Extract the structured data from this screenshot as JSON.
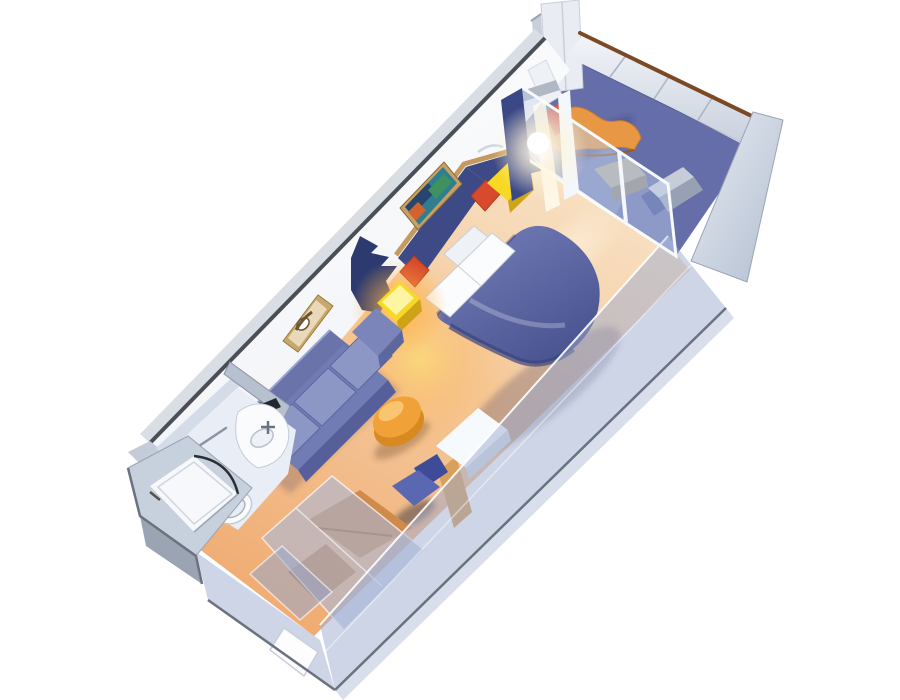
{
  "scene": {
    "type": "3d-cutaway-render",
    "subject": "balcony stateroom floor plan rendering",
    "background": "#ffffff"
  },
  "rooms": [
    {
      "name": "bedroom-sitting-area",
      "floor_color": "#f0ac72"
    },
    {
      "name": "bathroom",
      "floor_color": "#e9eef6"
    },
    {
      "name": "wardrobe-entry-corridor",
      "floor_color": "#f0ac72"
    },
    {
      "name": "private-balcony",
      "floor_color": "#656ea9"
    }
  ],
  "objects": [
    "queen-bed",
    "white-pillows",
    "red-accent-cushion-left",
    "red-accent-cushion-right",
    "nightstand-left-lit",
    "nightstand-right",
    "headboard",
    "privacy-curtain",
    "door-curtain",
    "sofa",
    "coffee-table",
    "vanity-desk",
    "desk-chair",
    "seascape-art",
    "sketch-art",
    "bathroom-vanity",
    "toilet",
    "shower-stall",
    "towel-bar",
    "wardrobe-closet",
    "entry-door",
    "balcony-lounge-chair",
    "balcony-side-table",
    "balcony-chair",
    "balcony-railing",
    "balcony-divider-panel",
    "glass-balcony-door",
    "neighbor-cabin-wall",
    "sun-flare"
  ],
  "palette": {
    "bg": "#ffffff",
    "wall_face": "#fdfdfe",
    "wall_edge_dark": "#4a4f57",
    "wall_outer_strip": "#d9dde4",
    "panel_light": "#e9edf3",
    "panel_mid": "#c8cfdb",
    "rail_brown": "#7a4a26",
    "sail_echo": "#aab4c6",
    "balcony_floor": "#656ea9",
    "lounge_orange": "#e89744",
    "lounge_cushion": "#de5034",
    "balcony_table_top": "#b3ab9c",
    "balcony_table_side": "#8d8679",
    "balcony_chair": "#3d4a90",
    "ac_top": "#c6cdd9",
    "ac_side": "#98a1b4",
    "bed_skirt": "#39437e",
    "pillow": "#fbfcfe",
    "pillow_back": "#eef1f6",
    "cushion_red": "#d84a2c",
    "nightstand_top": "#f7d925",
    "nightstand_side": "#cfa318",
    "nightstand_core": "#fff9b8",
    "headboard_navy": "#3d4a85",
    "headboard_trim": "#c49a5e",
    "curtain_navy": "#2c3a70",
    "door_curtain": "#3a4886",
    "art1_frame": "#c9a063",
    "art1_teal": "#2f7f90",
    "art1_navy": "#27456e",
    "art1_green": "#3f9160",
    "art1_orange": "#d2622e",
    "art2_frame": "#c8a86a",
    "art2_inner": "#ead9b8",
    "sofa_back": "#6a73aa",
    "sofa_seat": "#717cb4",
    "sofa_cushion": "#8d97c6",
    "sofa_skirt": "#565f9a",
    "table_side": "#d8891f",
    "table_top": "#f0a238",
    "desk_top": "#f7fafc",
    "desk_side": "#d4dae4",
    "chair_seat": "#5a68b2",
    "chair_back": "#3e4c98",
    "bath_floor": "#e9eef6",
    "bath_wall_shade": "#d4dce8",
    "divider_wall": "#b7c0ce",
    "fixture_white": "#fafbfd",
    "fixture_soft": "#eff2f7",
    "mirror_slot": "#232830",
    "shower_block": "#c7d0dd",
    "shower_floor": "#f6f8fb",
    "shower_skirt": "#9aa4b2",
    "closet_wood": "#d08a4a",
    "closet_wood_dark": "#c57f41",
    "closet_wood_strip": "#d9a05c",
    "front_wall": "rgba(158,172,208,0.5)",
    "front_wall_end": "rgba(165,178,210,0.55)",
    "front_wall_skirt": "rgba(185,195,220,0.55)",
    "glass_tint": "rgba(190,208,238,0.45)",
    "frame_white": "#f4f7fb",
    "column_white": "#eef1f6",
    "column_cap": "#b0b8c4",
    "outer_line": "#6a7280",
    "entry_door": "#fdfdfe"
  }
}
